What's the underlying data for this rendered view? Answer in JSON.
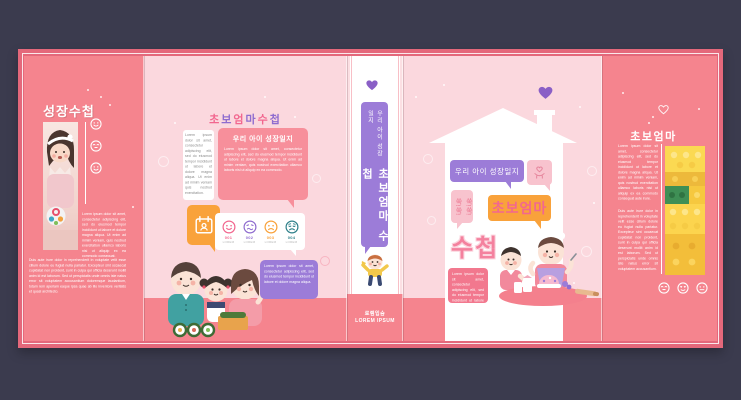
{
  "palette": {
    "background": "#3B3B4E",
    "bleed_pink": "#E4687B",
    "flap_pink": "#F5848E",
    "cover_pink": "#FBD8DE",
    "accent_pink": "#F2678F",
    "purple": "#9C7CD8",
    "orange": "#F9A23B",
    "teal": "#2F808A",
    "white": "#FFFFFF"
  },
  "left_flap": {
    "title": "성장수첩",
    "photo": "baby-with-toy-ball-photo",
    "emoji_icons": [
      "smile",
      "laugh",
      "smile"
    ],
    "paragraph_1": "Lorem ipsum dolor sit amet, consectetur adipiscing elit, sed do eiusmod tempor incididunt ut labore et dolore magna aliqua. Ut enim ad minim veniam, quis nostrud exercitation ullamco laboris nisi ut aliquip ex ea commodo consequat.",
    "paragraph_2": "Duis aute irure dolor in reprehenderit in voluptate velit esse cillum dolore eu fugiat nulla pariatur. Excepteur sint occaecat cupidatat non proident, sunt in culpa qui officia deserunt mollit anim id est laborum. Sed ut perspiciatis unde omnis iste natus error sit voluptatem accusantium doloremque laudantium, totam rem aperiam eaque ipsa quae ab illo inventore veritatis et quasi architecto."
  },
  "back_cover": {
    "title_chars": [
      "초",
      "보",
      "엄",
      "마",
      "수",
      "첩"
    ],
    "quote_bubble_text": "Lorem ipsum dolor sit amet, consectetur adipiscing elit, sed do eiusmod tempor incididunt ut labore et dolore magna aliqua. Ut enim ad minim veniam quis nostrud exercitation.",
    "intro_bubble": {
      "title": "우리 아이 성장일지",
      "body": "Lorem ipsum dolor sit amet, consectetur adipiscing elit, sed do eiusmod tempor incididunt ut labore et dolore magna aliqua. Ut enim ad minim veniam, quis nostrud exercitation ullamco laboris nisi ut aliquip ex ea commodo."
    },
    "calendar_icon": "calendar-icon",
    "ratings": [
      {
        "num": "001",
        "label": "LOREM",
        "face": "smile",
        "color": "#F2678F"
      },
      {
        "num": "002",
        "label": "LOREM",
        "face": "uneasy",
        "color": "#8F6CCF"
      },
      {
        "num": "003",
        "label": "LOREM",
        "face": "frown",
        "color": "#F9A23B"
      },
      {
        "num": "004",
        "label": "LOREM",
        "face": "cry",
        "color": "#2F808A"
      }
    ],
    "family_bubble_text": "Lorem ipsum dolor sit amet, consectetur adipiscing elit, sed do eiusmod tempor incididunt ut labore et dolore magna aliqua.",
    "family_illustration": "family-eating-kimbap-illustration"
  },
  "spine": {
    "subtitle": "우리 아이 성장일지",
    "title": "초보엄마 수첩",
    "kid_illustration": "waving-kid-illustration",
    "publisher_kr": "로렘입숨",
    "publisher_en": "LOREM IPSUM"
  },
  "front_cover": {
    "subtitle": "우리 아이 성장일지",
    "growth_text": "쑥!쑥!\n쑥!쑥!",
    "title_line1": "초보엄마",
    "title_line2": "수첩",
    "body_text": "Lorem ipsum dolor sit amet, consectetur adipiscing elit, sed do eiusmod tempor incididunt ut labore et dolore magna.",
    "hand_heart_icon": "hand-heart-icon",
    "illustration": "mom-and-daughter-baking-illustration"
  },
  "right_flap": {
    "title": "초보엄마",
    "photo": "yellow-lego-bricks-photo",
    "emoji_icons": [
      "laugh",
      "heart-eyes",
      "neutral"
    ],
    "paragraph_1": "Lorem ipsum dolor sit amet, consectetur adipiscing elit, sed do eiusmod tempor incididunt ut labore et dolore magna aliqua. Ut enim ad minim veniam, quis nostrud exercitation ullamco laboris nisi ut aliquip ex ea commodo consequat aute irure.",
    "paragraph_2": "Duis aute irure dolor in reprehenderit in voluptate velit esse cillum dolore eu fugiat nulla pariatur. Excepteur sint occaecat cupidatat non proident, sunt in culpa qui officia deserunt mollit anim id est laborum. Sed ut perspiciatis unde omnis iste natus error sit voluptatem accusantium."
  }
}
